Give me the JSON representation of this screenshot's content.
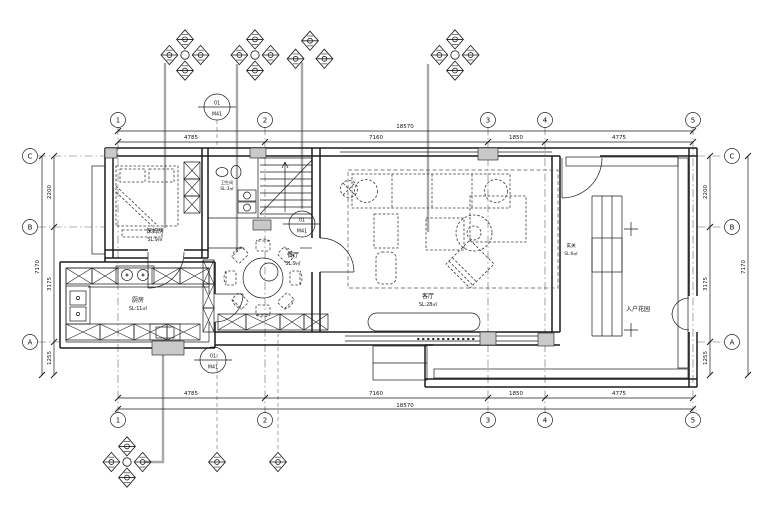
{
  "grid": {
    "cols": [
      "1",
      "2",
      "3",
      "4",
      "5"
    ],
    "rows": [
      "C",
      "B",
      "A"
    ]
  },
  "dims": {
    "h": {
      "overall": "18570",
      "segs": [
        "4785",
        "7160",
        "1850",
        "4775"
      ]
    },
    "v": {
      "overall": "7170",
      "segs": [
        "2200",
        "3175",
        "1255"
      ]
    }
  },
  "rooms": {
    "maid": {
      "name": "保姆房",
      "area": "SL:9㎡"
    },
    "bath": {
      "name": "卫生间",
      "area": "SL:3㎡"
    },
    "kitchen": {
      "name": "厨房",
      "area": "SL:11㎡"
    },
    "dining": {
      "name": "餐厅",
      "area": "SL:9㎡"
    },
    "living": {
      "name": "客厅",
      "area": "SL:28㎡"
    },
    "foyer": {
      "name": "玄关",
      "area": "SL:6㎡"
    },
    "garden": {
      "name": "入户花园"
    }
  },
  "markers": {
    "door_tag": {
      "line1": "01",
      "line2": "M41"
    }
  },
  "colors": {
    "line": "#1c1c1c",
    "leader": "#a9a9a9",
    "column_fill": "#c9c9c9",
    "background": "#ffffff"
  }
}
